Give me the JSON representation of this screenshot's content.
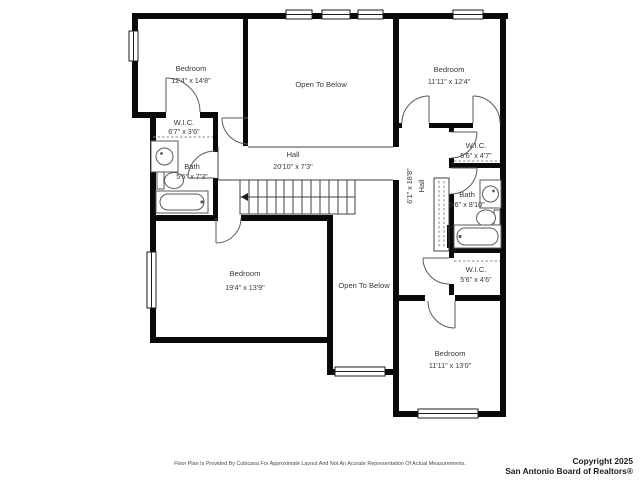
{
  "plan": {
    "rooms": {
      "bedroom_top_left": {
        "name": "Bedroom",
        "dims": "12'4\" x 14'8\""
      },
      "open_to_below_top": {
        "name": "Open To Below"
      },
      "bedroom_top_right": {
        "name": "Bedroom",
        "dims": "11'11\" x 12'4\""
      },
      "wic_left": {
        "name": "W.I.C.",
        "dims": "6'7\" x 3'6\""
      },
      "bath_left": {
        "name": "Bath",
        "dims": "5'5\" x 7'3\""
      },
      "hall_main": {
        "name": "Hall",
        "dims": "20'10\" x 7'3\""
      },
      "bedroom_large": {
        "name": "Bedroom",
        "dims": "19'4\" x 13'9\""
      },
      "open_to_below_bottom": {
        "name": "Open To Below"
      },
      "hall_upper": {
        "name": "Hall",
        "dims": "6'1\" x 18'8\""
      },
      "wic_right_top": {
        "name": "W.I.C.",
        "dims": "5'6\" x 4'7\""
      },
      "bath_right": {
        "name": "Bath",
        "dims": "5'6\" x 8'10\""
      },
      "wic_right_bottom": {
        "name": "W.I.C.",
        "dims": "5'6\" x 4'6\""
      },
      "bedroom_bottom_right": {
        "name": "Bedroom",
        "dims": "11'11\" x 13'0\""
      }
    },
    "footer": {
      "disclaimer": "Floor Plan Is Provided By Cubicasa For Approximate Layout And Not An Acurate Representation Of Actual Measurements.",
      "copyright_line1": "Copyright 2025",
      "copyright_line2": "San Antonio Board of Realtors®"
    },
    "colors": {
      "wall": "#0a0a0a",
      "background": "#ffffff",
      "label": "#3a3a3a"
    }
  }
}
